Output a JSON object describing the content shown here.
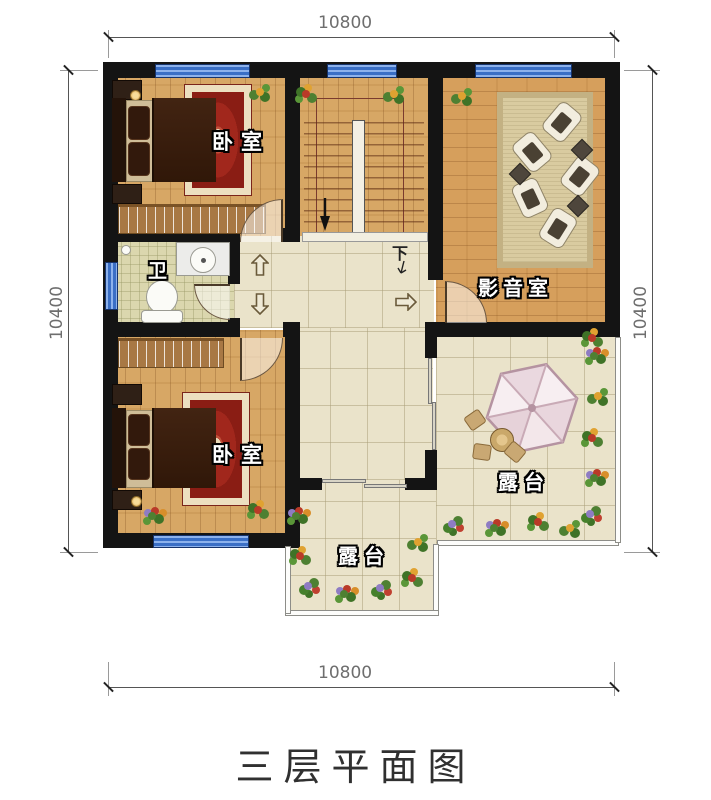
{
  "title": "三层平面图",
  "dims": {
    "top": "10800",
    "bottom": "10800",
    "left": "10400",
    "right": "10400"
  },
  "rooms": {
    "bedroom_top": {
      "label": "卧室"
    },
    "bathroom": {
      "label": "卫"
    },
    "media_room": {
      "label": "影音室"
    },
    "bedroom_bottom": {
      "label": "卧室"
    },
    "terrace_right": {
      "label": "露台"
    },
    "terrace_bottom": {
      "label": "露台"
    }
  },
  "stairs": {
    "down_label": "下"
  },
  "colors": {
    "wall": "#141414",
    "window": "#3a6fc6",
    "wood_floor": "#d7a765",
    "tile_floor": "#eae3ca",
    "bath_tile": "#dbd7ae",
    "rug_red": "#a1271c",
    "umbrella": "#f3e7ea",
    "label_text": "#ffffff",
    "dimension_text": "#6e6e6e",
    "title_text": "#303030"
  }
}
